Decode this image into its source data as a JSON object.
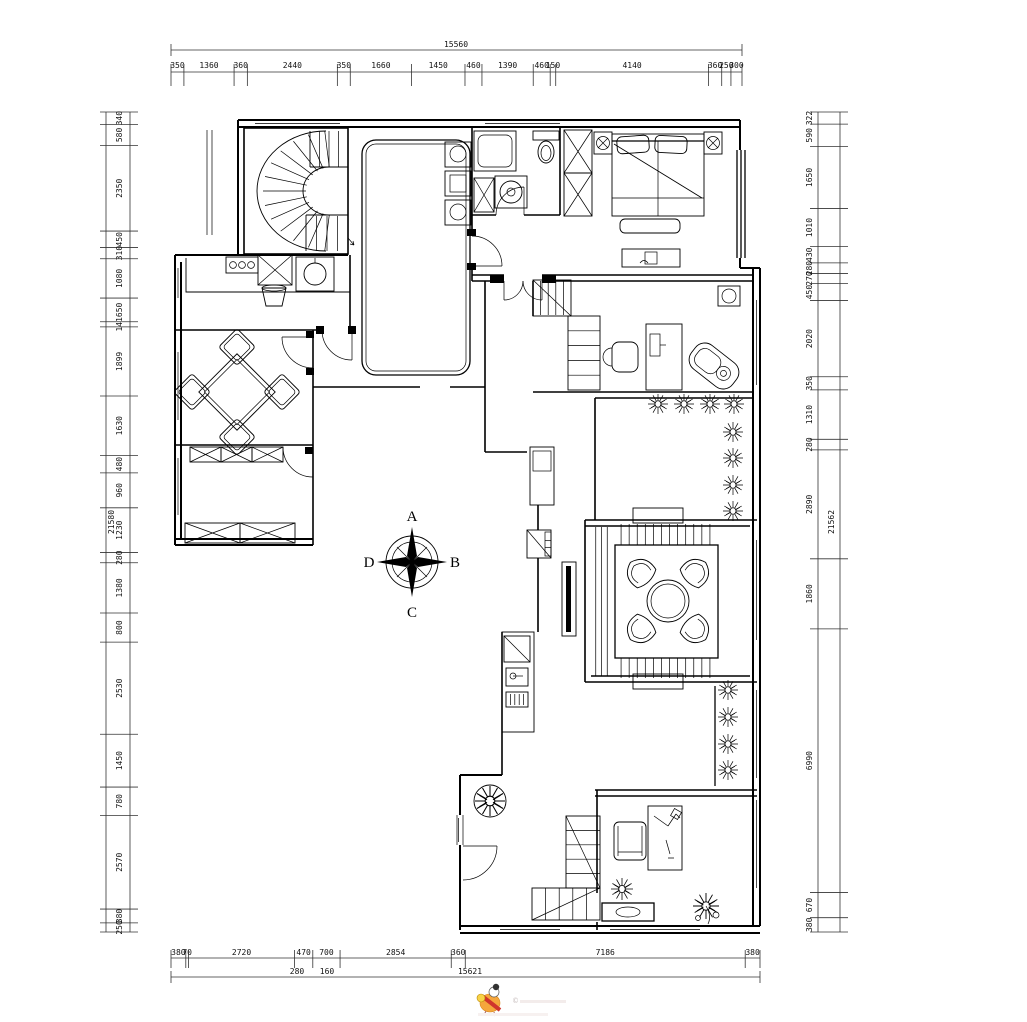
{
  "dimensions": {
    "top": {
      "total": "15560",
      "segments": [
        "350",
        "1360",
        "360",
        "2440",
        "350",
        "1660",
        "1450",
        "460",
        "1390",
        "460",
        "150",
        "4140",
        "360",
        "250",
        "300"
      ]
    },
    "bottom": {
      "total": "15621",
      "segments": [
        "380",
        "70",
        "2720",
        "470",
        "700",
        "2854",
        "360",
        "7186",
        "380"
      ],
      "sub_segments": [
        "280",
        "160"
      ]
    },
    "left": {
      "total": "21580",
      "segments": [
        "340",
        "580",
        "2350",
        "450",
        "310",
        "1080",
        "650",
        "141",
        "1899",
        "1630",
        "480",
        "960",
        "1230",
        "280",
        "1380",
        "800",
        "2530",
        "1450",
        "780",
        "2570",
        "380",
        "250"
      ]
    },
    "right": {
      "total": "21562",
      "segments": [
        "322",
        "590",
        "1650",
        "1010",
        "430",
        "280",
        "270",
        "450",
        "2020",
        "350",
        "1310",
        "280",
        "2890",
        "1860",
        "6990",
        "670",
        "380"
      ]
    }
  },
  "compass": {
    "north_label": "A",
    "east_label": "B",
    "south_label": "C",
    "west_label": "D"
  },
  "watermark": {
    "copyright_symbol": "©"
  }
}
